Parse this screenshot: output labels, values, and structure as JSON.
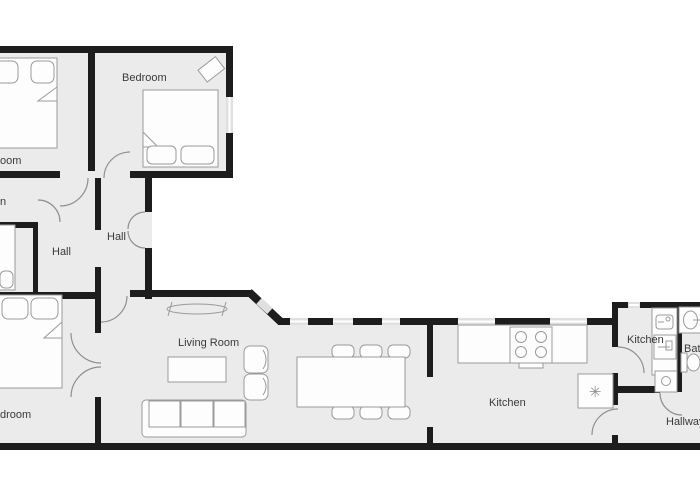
{
  "colors": {
    "background": "#ffffff",
    "wall": "#1d1d1d",
    "floor": "#ebebeb",
    "windowFill": "#e0e0e0",
    "furnitureFill": "#fdfdfd",
    "furnitureStroke": "#9a9a9a",
    "doorStroke": "#8f8f8f",
    "text": "#3a3a3a"
  },
  "rooms": [
    {
      "id": "bedroom-top-left-partial",
      "label": "oom"
    },
    {
      "id": "bedroom-top",
      "label": "Bedroom"
    },
    {
      "id": "room-left-partial",
      "label": "n"
    },
    {
      "id": "hall-upper",
      "label": "Hall"
    },
    {
      "id": "hall-lower",
      "label": "Hall"
    },
    {
      "id": "bedroom-bottom-left-partial",
      "label": "droom"
    },
    {
      "id": "living-room",
      "label": "Living Room"
    },
    {
      "id": "kitchen-main",
      "label": "Kitchen"
    },
    {
      "id": "kitchen-small",
      "label": "Kitchen"
    },
    {
      "id": "bathroom-partial",
      "label": "Bat"
    },
    {
      "id": "hallway",
      "label": "Hallway"
    }
  ],
  "icons": {
    "fridge_snowflake": "✳"
  },
  "furniture": {
    "bedroom_top": [
      "double-bed",
      "tilted-cabinet"
    ],
    "bedroom_top_left": [
      "double-bed"
    ],
    "left_room": [
      "single-bed"
    ],
    "bedroom_bottom_left": [
      "double-bed"
    ],
    "living_room": [
      "sofa",
      "coffee-table",
      "armchair",
      "armchair",
      "radiator-bench"
    ],
    "dining_area": [
      "dining-table",
      "dining-chairs-6"
    ],
    "kitchen_main": [
      "counter",
      "stove",
      "fridge"
    ],
    "kitchen_small": [
      "counter",
      "sink",
      "oven",
      "washing-machine"
    ],
    "bathroom": [
      "sink",
      "toilet"
    ]
  }
}
